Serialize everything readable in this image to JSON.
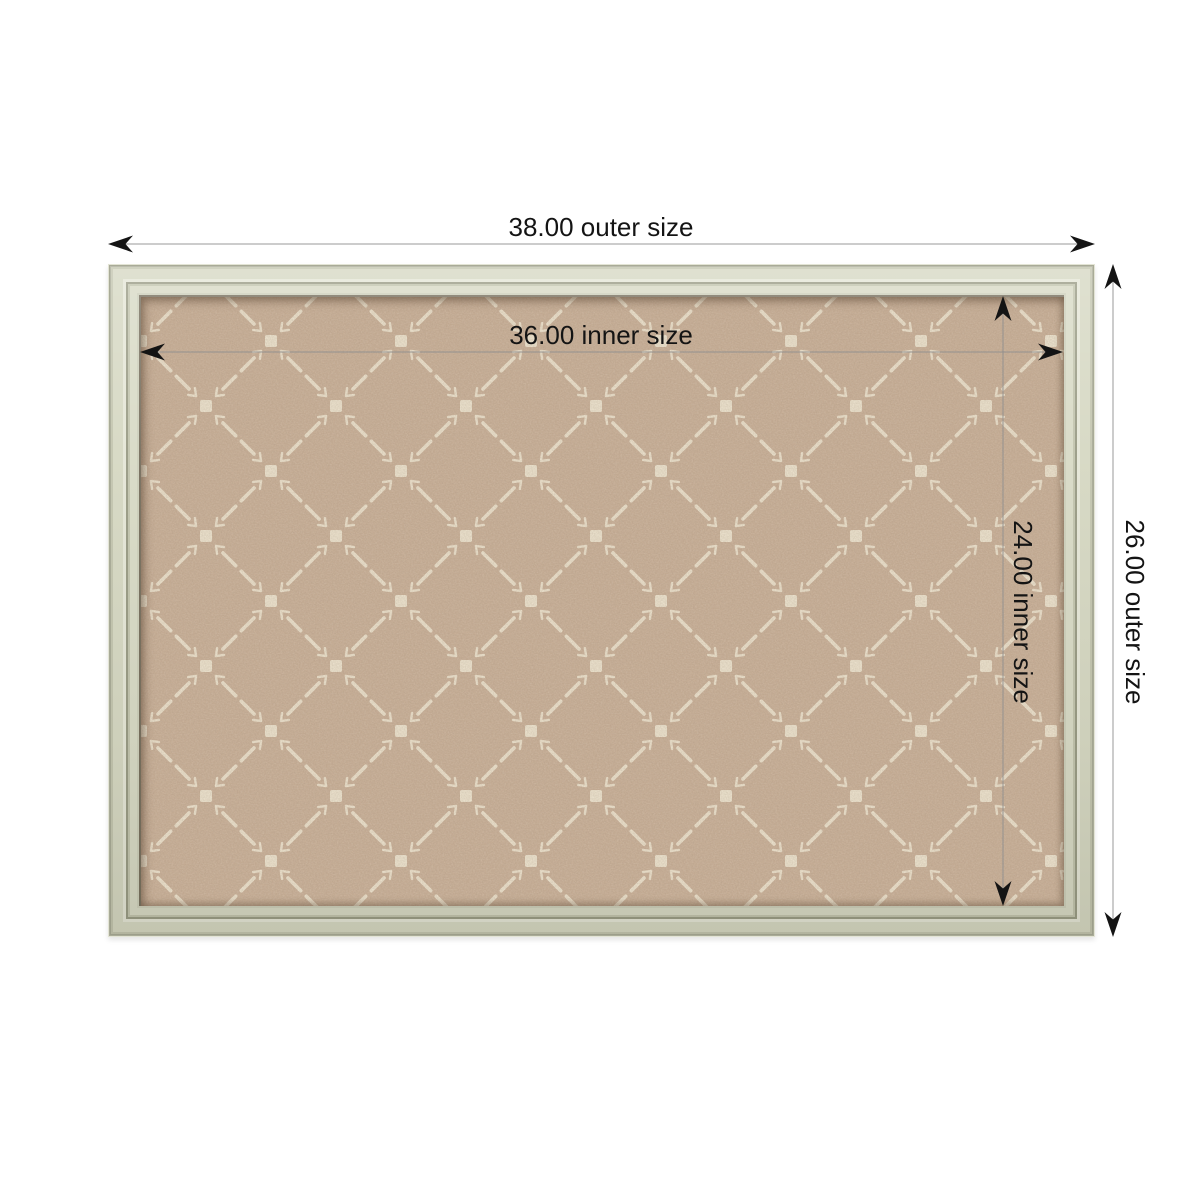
{
  "diagram": {
    "type": "product-dimension-diagram",
    "labels": {
      "outer_width": "38.00 outer size",
      "inner_width": "36.00 inner size",
      "inner_height": "24.00 inner size",
      "outer_height": "26.00 outer size"
    },
    "values": {
      "outer_width": 38.0,
      "inner_width": 36.0,
      "inner_height": 24.0,
      "outer_height": 26.0
    },
    "board": {
      "frame_color": "#d6d8c3",
      "frame_highlight": "#e5e6d7",
      "frame_groove": "#999b85",
      "fabric_color": "#c7ae96",
      "motif_color": "#ece2cd"
    },
    "annotation": {
      "line_color": "#8f8f8f",
      "arrow_color": "#141414",
      "text_color": "#141414",
      "background": "#ffffff"
    }
  }
}
